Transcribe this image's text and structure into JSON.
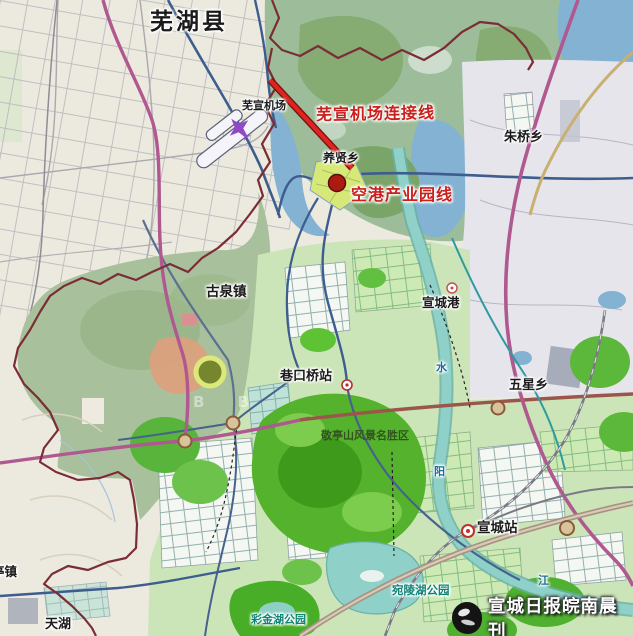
{
  "labels": {
    "wuhu_county": "芜湖县",
    "wuxuan_airport": "芜宣机场",
    "yangxian_township": "养贤乡",
    "zhuqiao_township": "朱桥乡",
    "guquan_town": "古泉镇",
    "xuancheng_port": "宣城港",
    "wuxing_township": "五星乡",
    "xiangkouqiao_station": "巷口桥站",
    "jingtingshan_scenic_area": "敬亭山风景名胜区",
    "xuancheng_station": "宣城站",
    "wanling_lake_park": "宛陵湖公园",
    "caijin_lake_park": "彩金湖公园",
    "tianhu_lake": "天湖",
    "partial_town_edge": "亭镇",
    "river_char_shui": "水",
    "river_char_yang": "阳",
    "river_char_jiang": "江"
  },
  "highlight_labels": {
    "airport_connection_line": "芜宣机场连接线",
    "airport_industrial_park_line": "空港产业园线"
  },
  "watermark": {
    "press_name": "宣城日报皖南晨刊",
    "faint_letters": "B B"
  },
  "icons": [
    "airplane-icon",
    "red-dot-marker",
    "railway-station-icon",
    "port-icon",
    "interchange-icon",
    "press-logo-icon"
  ],
  "colors": {
    "highlight_red": "#c9201d",
    "red_line": "#e02420",
    "county_boundary": "#7b2d35",
    "expressway_magenta": "#b05890",
    "major_road_navy": "#3e5d8f",
    "river_teal": "#8fd0c8",
    "park_green": "#54b22c",
    "scenic_green": "#3d9a1a",
    "water_blue": "#84b2d2",
    "land_cream": "#eceadf",
    "press_text": "#ffffff"
  }
}
